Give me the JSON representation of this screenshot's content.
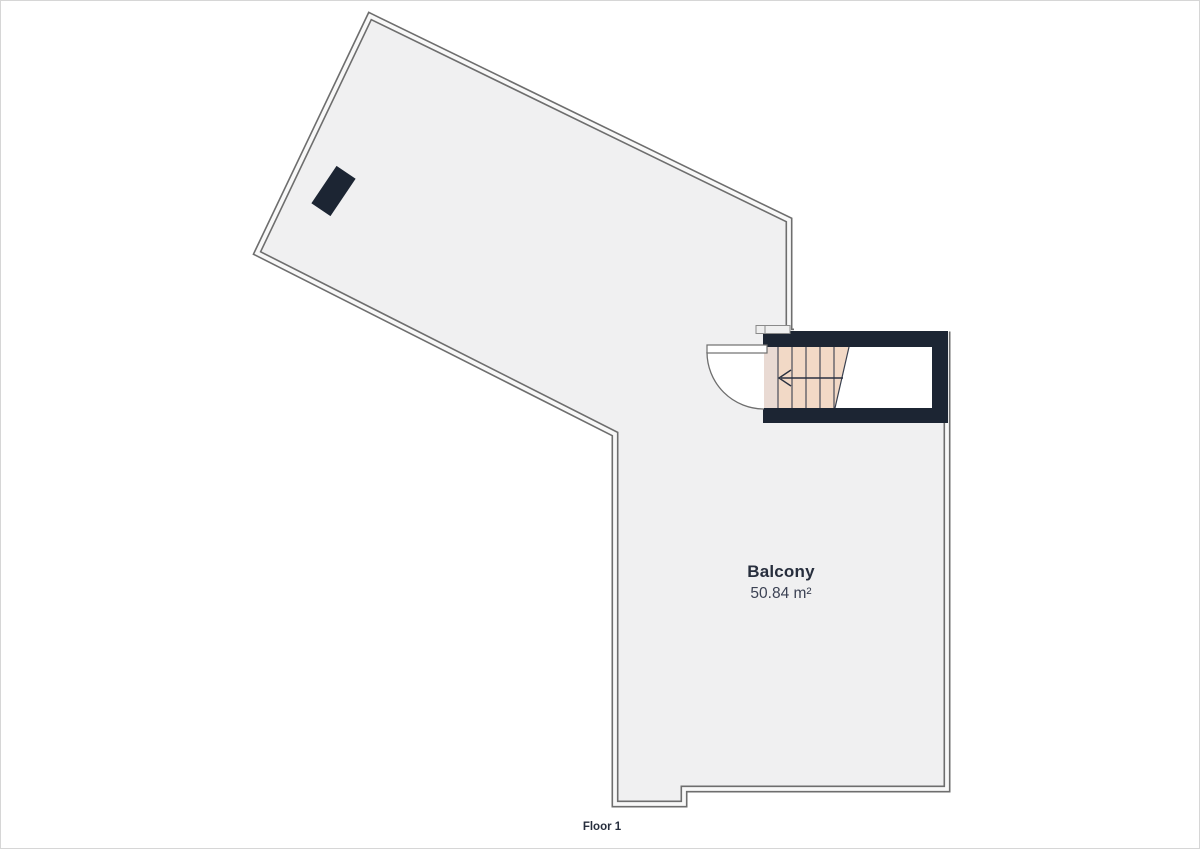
{
  "floorplan": {
    "floor_label": "Floor 1",
    "room": {
      "name": "Balcony",
      "area": "50.84 m²"
    },
    "features": {
      "staircase": "enclosed stair with left direction arrow",
      "door": "quarter-circle swing door at stair entrance",
      "object": "dark rotated rectangle (roof window)"
    }
  },
  "icons": {
    "stair_direction_arrow": "arrow-left"
  },
  "colors": {
    "wall": "#1c2533",
    "floor_fill": "#f0f0f1",
    "outline": "#6e6e6e",
    "stair_fill": "#f2d9c6",
    "stair_landing_fill": "#e9dad3",
    "stair_line": "#39404f",
    "door_swing_fill": "#ffffff",
    "label_text": "#272e3d",
    "page_border": "#d6d6d6",
    "background": "#ffffff"
  }
}
